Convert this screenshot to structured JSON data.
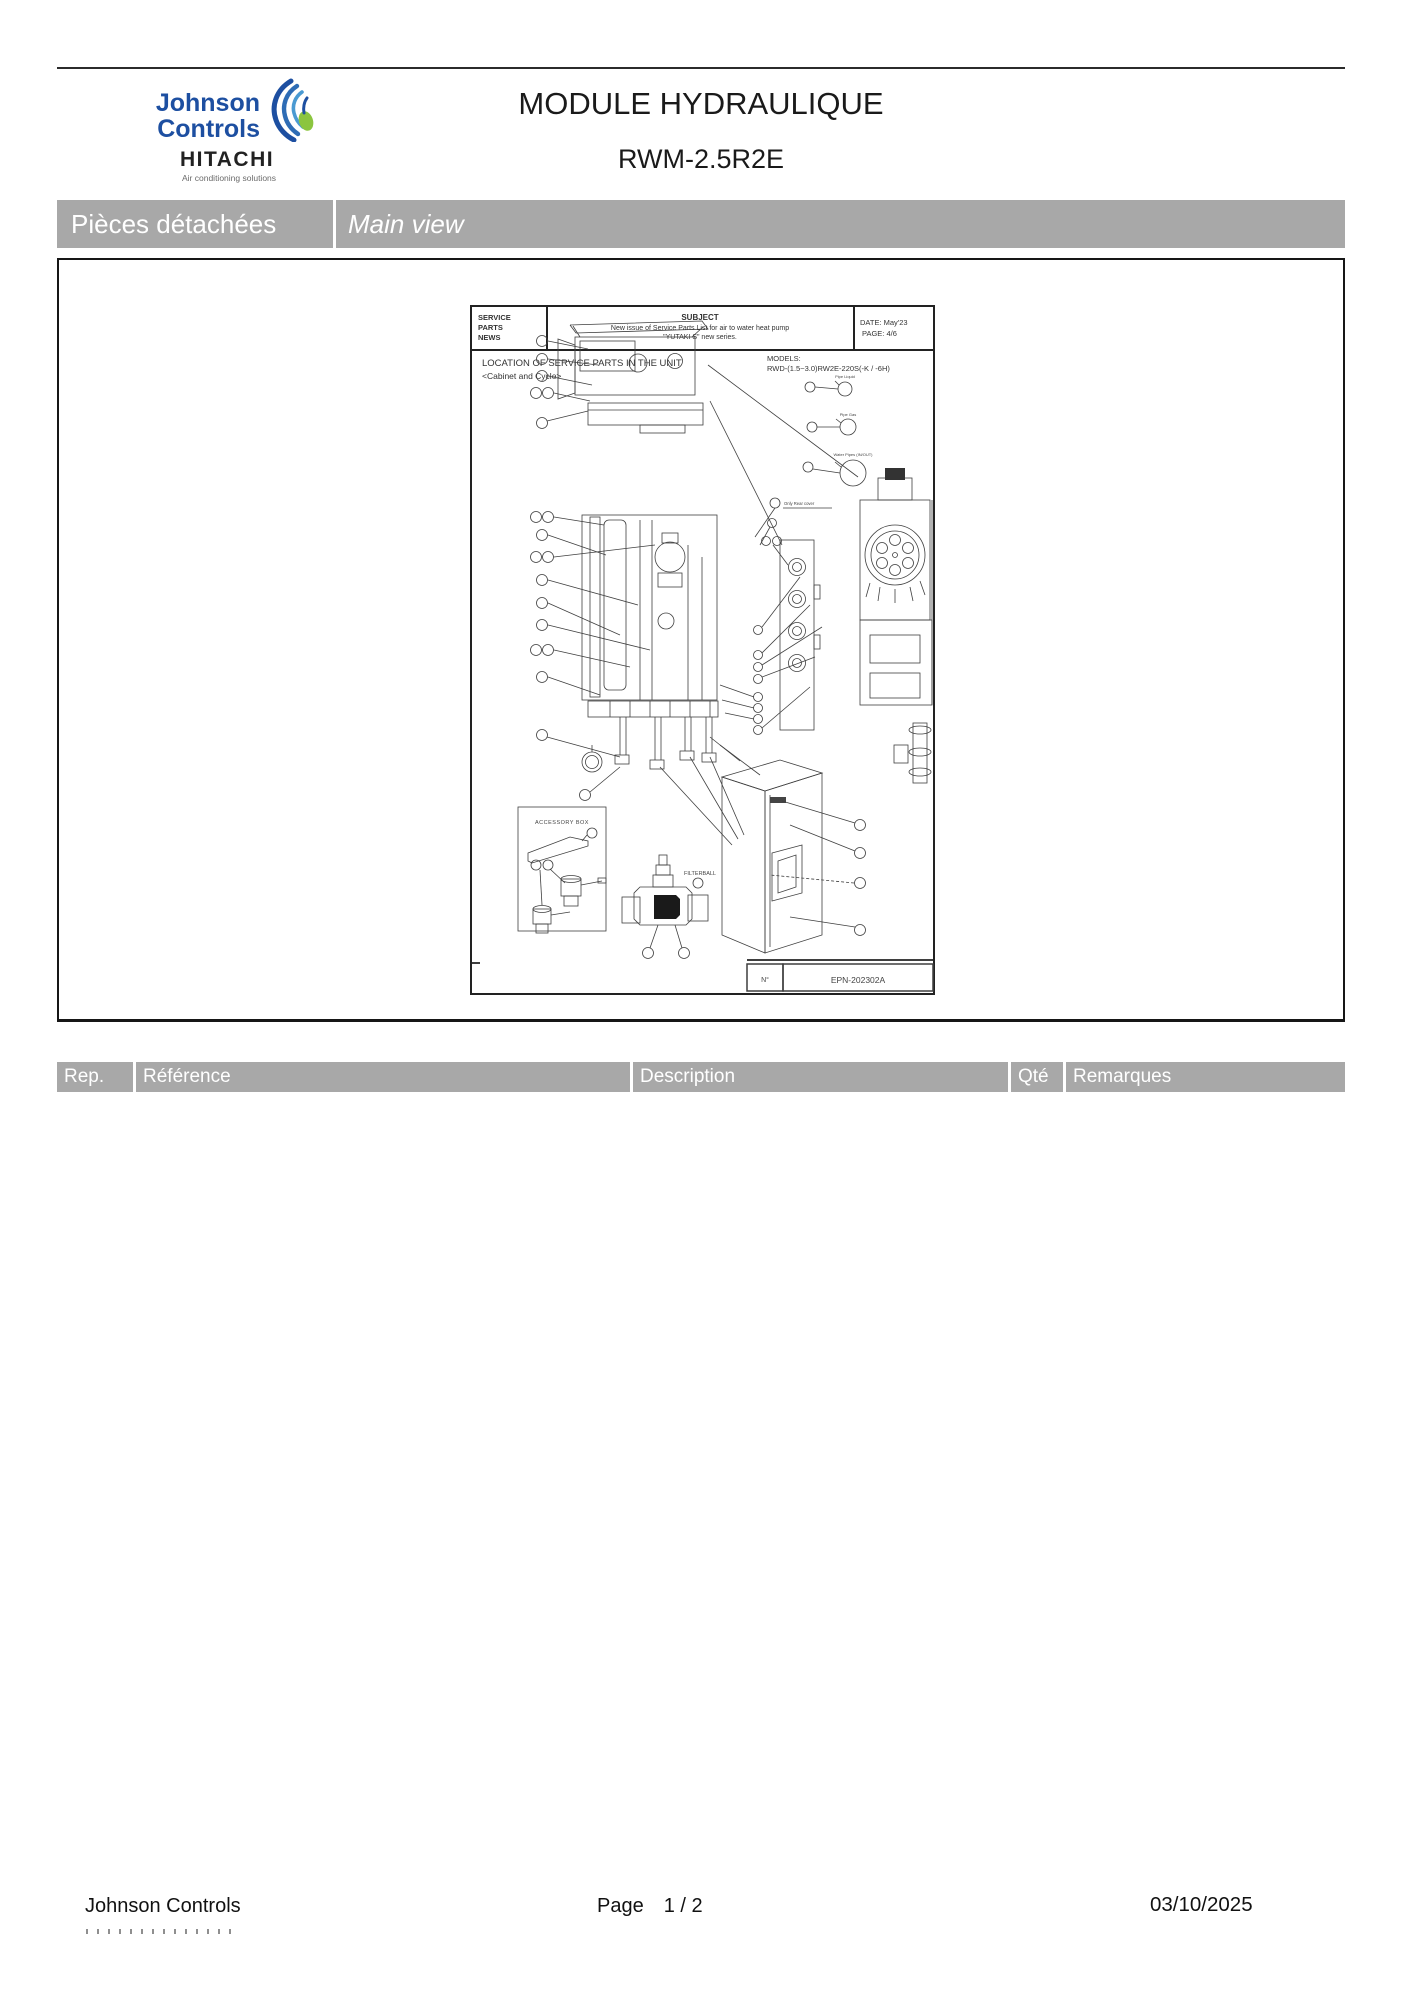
{
  "header": {
    "brand": {
      "line1": "Johnson",
      "line2": "Controls",
      "hitachi": "HITACHI",
      "tagline": "Air conditioning solutions"
    },
    "title": "MODULE HYDRAULIQUE",
    "subtitle": "RWM-2.5R2E"
  },
  "section_bar": {
    "left": "Pièces détachées",
    "right": "Main view"
  },
  "drawing_doc": {
    "masthead": {
      "col1": [
        "SERVICE",
        "PARTS",
        "NEWS"
      ],
      "subject_label": "SUBJECT",
      "subject_line1": "New issue of Service Parts List for air to water heat pump",
      "subject_line2": "\"YUTAKI S\" new series.",
      "date": "DATE: May'23",
      "page": "PAGE:    4/6"
    },
    "location_title": "LOCATION OF SERVICE PARTS IN THE UNIT",
    "location_subtitle": "<Cabinet and Cycle>",
    "models_label": "MODELS:",
    "models_value": "RWD-(1.5~3.0)RW2E-220S(-K / -6H)",
    "labels": {
      "accessory_box": "ACCESSORY BOX",
      "filterball": "FILTERBALL",
      "pipe_liquid": "Pipe Liquid",
      "pipe_gas": "Pipe Gas",
      "pipe_water": "Water Pipes (IN/OUT)",
      "only_note": "Only Rear cover"
    },
    "doc_footer": {
      "no_label": "N°",
      "no_value": "EPN-202302A"
    }
  },
  "table": {
    "headers": [
      "Rep.",
      "Référence",
      "Description",
      "Qté",
      "Remarques"
    ]
  },
  "footer": {
    "left": "Johnson Controls",
    "page_label": "Page",
    "page_value": "1 / 2",
    "date": "03/10/2025"
  },
  "colors": {
    "bar_gray": "#a8a8a8",
    "brand_blue": "#1d4fa1",
    "brand_green": "#8bc53f",
    "line_dark": "#2b2b2b"
  }
}
